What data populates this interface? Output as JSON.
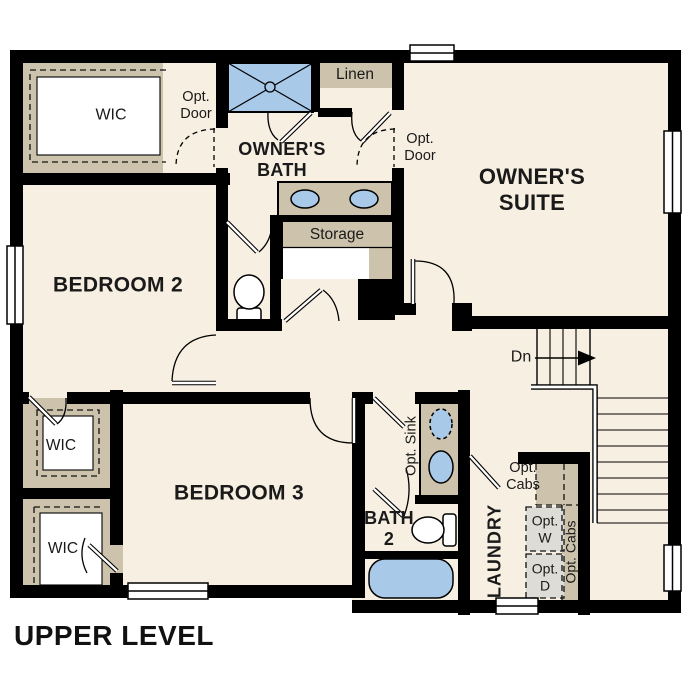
{
  "title": "UPPER LEVEL",
  "colors": {
    "wall": "#000000",
    "floor": "#f7efe2",
    "tan": "#cdc3ad",
    "fixture_blue": "#a9c9e9",
    "appliance_gray": "#dddcd6",
    "white": "#ffffff"
  },
  "rooms": {
    "owners_suite": {
      "line1": "OWNER'S",
      "line2": "SUITE"
    },
    "owners_bath": {
      "line1": "OWNER'S",
      "line2": "BATH"
    },
    "bedroom2": {
      "label": "BEDROOM 2"
    },
    "bedroom3": {
      "label": "BEDROOM 3"
    },
    "bath2": {
      "line1": "BATH",
      "line2": "2"
    },
    "laundry": {
      "label": "LAUNDRY"
    },
    "storage": {
      "label": "Storage"
    },
    "linen": {
      "label": "Linen"
    },
    "wic_owners": {
      "label": "WIC"
    },
    "wic_middle": {
      "label": "WIC"
    },
    "wic_lower": {
      "label": "WIC"
    }
  },
  "annotations": {
    "opt_door_left": {
      "line1": "Opt.",
      "line2": "Door"
    },
    "opt_door_right": {
      "line1": "Opt.",
      "line2": "Door"
    },
    "opt_sink": {
      "label": "Opt. Sink"
    },
    "opt_cabs_hall": {
      "line1": "Opt.",
      "line2": "Cabs"
    },
    "opt_cabs_side": {
      "label": "Opt. Cabs"
    },
    "opt_washer": {
      "line1": "Opt.",
      "line2": "W"
    },
    "opt_dryer": {
      "line1": "Opt.",
      "line2": "D"
    },
    "stairs_down": {
      "label": "Dn"
    }
  }
}
